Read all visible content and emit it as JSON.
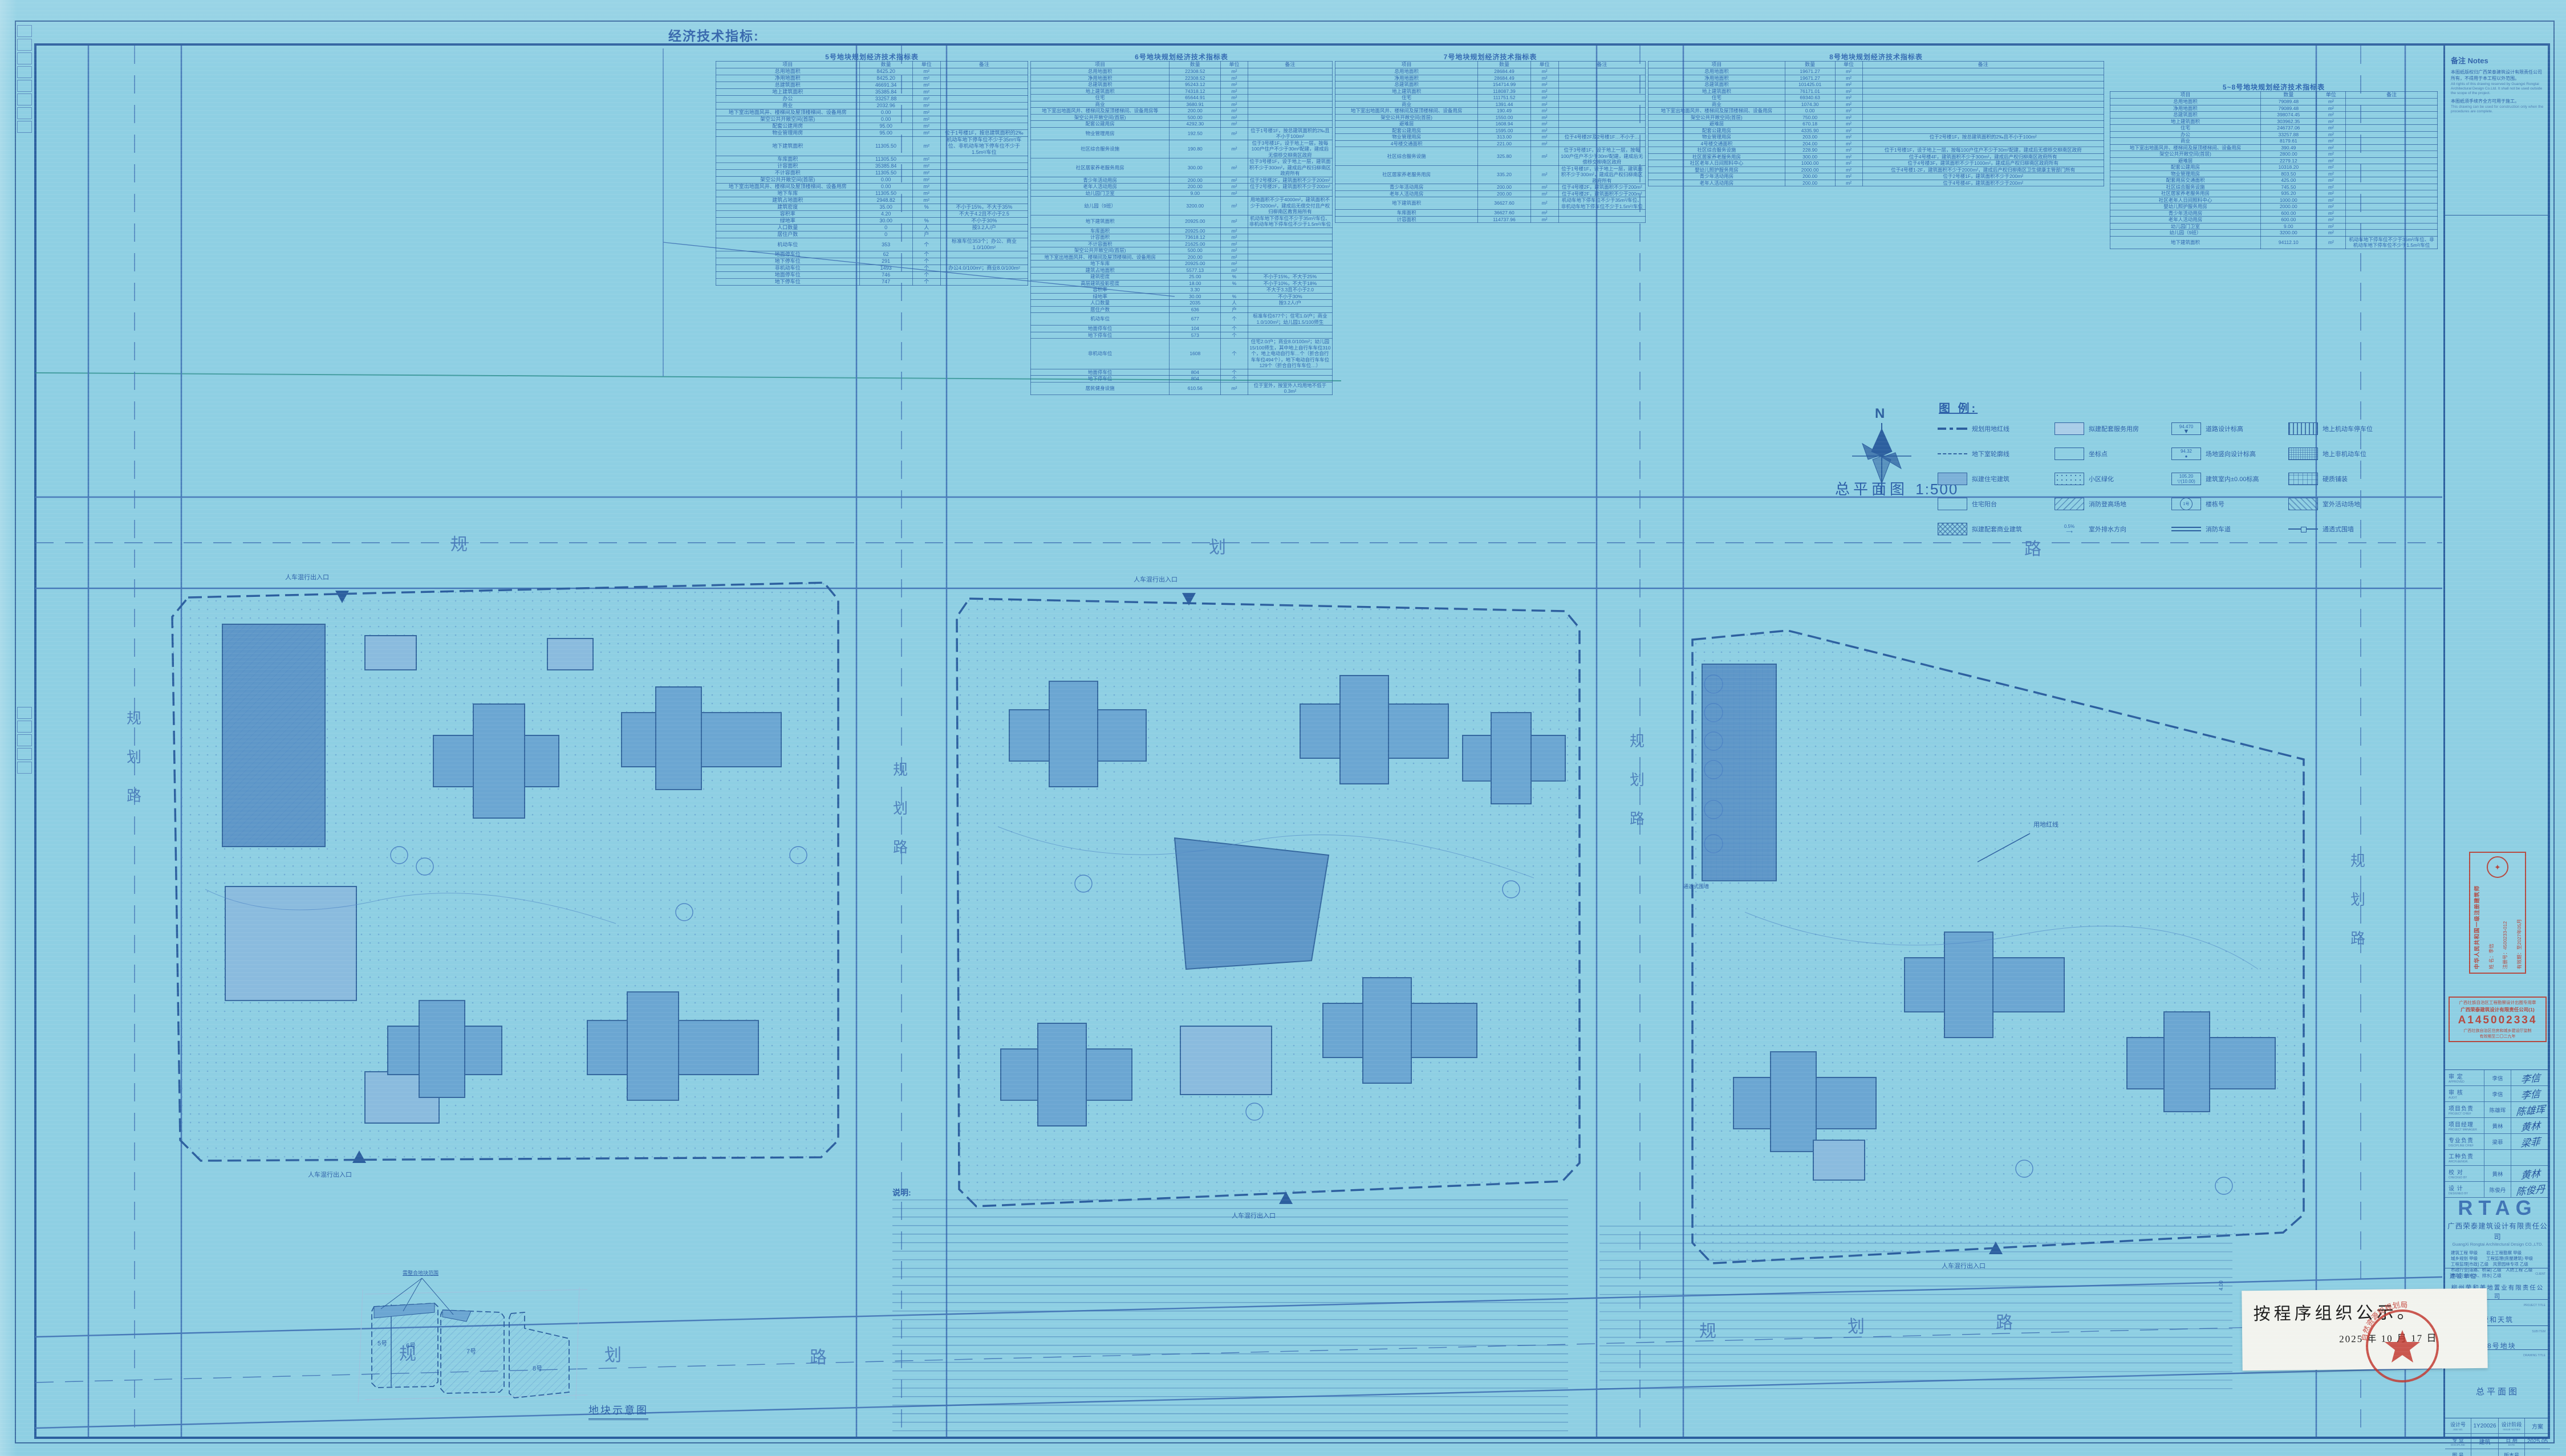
{
  "sheet": {
    "econ_label": "经济技术指标:",
    "plan_title": "总平面图",
    "plan_scale": "1:500",
    "north_letter": "N",
    "schematic_title": "地块示意图",
    "schematic_callout": "需整合地块范围",
    "schematic_plots": [
      "5号",
      "6号",
      "7号",
      "8号"
    ],
    "notes_heading": "说明:",
    "dim_label": "4.00"
  },
  "map_labels": {
    "road": "规划路",
    "road_chars": [
      "规",
      "划",
      "路"
    ],
    "entrance": "人车混行出入口",
    "redline": "用地红线",
    "fence": "通透式围墙"
  },
  "tables": [
    {
      "title": "5号地块规划经济技术指标表",
      "headers": [
        "项目",
        "数量",
        "单位",
        "备注"
      ],
      "rows": [
        [
          "总用地面积",
          "8425.20",
          "m²",
          ""
        ],
        [
          "净用地面积",
          "8425.20",
          "m²",
          ""
        ],
        [
          "总建筑面积",
          "46691.34",
          "m²",
          ""
        ],
        [
          "地上建筑面积",
          "35385.84",
          "m²",
          ""
        ],
        [
          "办公",
          "33257.88",
          "m²",
          ""
        ],
        [
          "商业",
          "2032.96",
          "m²",
          ""
        ],
        [
          "地下室出地面风井、楼梯间及屋顶楼梯间、设备用房",
          "0.00",
          "m²",
          ""
        ],
        [
          "架空公共开敞空间(首层)",
          "0.00",
          "m²",
          ""
        ],
        [
          "配套公建用房",
          "95.00",
          "m²",
          ""
        ],
        [
          "物业管理用房",
          "95.00",
          "m²",
          "位于1号楼1F，按总建筑面积的2‰"
        ],
        [
          "地下建筑面积",
          "11305.50",
          "m²",
          "机动车地下停车位不少于35m²/车位、非机动车地下停车位不少于1.5m²/车位"
        ],
        [
          "车库面积",
          "11305.50",
          "m²",
          ""
        ],
        [
          "计容面积",
          "35385.84",
          "m²",
          ""
        ],
        [
          "不计容面积",
          "11305.50",
          "m²",
          ""
        ],
        [
          "架空公共开敞空间(首层)",
          "0.00",
          "m²",
          ""
        ],
        [
          "地下室出地面风井、楼梯间及屋顶楼梯间、设备用房",
          "0.00",
          "m²",
          ""
        ],
        [
          "地下车库",
          "11305.50",
          "m²",
          ""
        ],
        [
          "建筑占地面积",
          "2948.82",
          "m²",
          ""
        ],
        [
          "建筑密度",
          "35.00",
          "%",
          "不小于15%，不大于35%"
        ],
        [
          "容积率",
          "4.20",
          "",
          "不大于4.2且不小于2.5"
        ],
        [
          "绿地率",
          "30.00",
          "%",
          "不小于30%"
        ],
        [
          "人口数量",
          "0",
          "人",
          "按3.2人/户"
        ],
        [
          "居住户数",
          "0",
          "户",
          ""
        ],
        [
          "机动车位",
          "353",
          "个",
          "标准车位353个；办公、商业1.0/100m²"
        ],
        [
          "地面停车位",
          "62",
          "个",
          ""
        ],
        [
          "地下停车位",
          "291",
          "个",
          ""
        ],
        [
          "非机动车位",
          "1493",
          "个",
          "办公4.0/100m²；商业8.0/100m²"
        ],
        [
          "地面停车位",
          "746",
          "个",
          ""
        ],
        [
          "地下停车位",
          "747",
          "个",
          ""
        ]
      ]
    },
    {
      "title": "6号地块规划经济技术指标表",
      "headers": [
        "项目",
        "数量",
        "单位",
        "备注"
      ],
      "rows": [
        [
          "总用地面积",
          "22308.52",
          "m²",
          ""
        ],
        [
          "净用地面积",
          "22308.52",
          "m²",
          ""
        ],
        [
          "总建筑面积",
          "95243.12",
          "m²",
          ""
        ],
        [
          "地上建筑面积",
          "74318.12",
          "m²",
          ""
        ],
        [
          "住宅",
          "65644.91",
          "m²",
          ""
        ],
        [
          "商业",
          "3680.91",
          "m²",
          ""
        ],
        [
          "地下室出地面风井、楼梯间及屋顶楼梯间、设备用房等",
          "200.00",
          "m²",
          ""
        ],
        [
          "架空公共开敞空间(首层)",
          "500.00",
          "m²",
          ""
        ],
        [
          "配套公建用房",
          "4292.30",
          "m²",
          ""
        ],
        [
          "物业管理用房",
          "192.50",
          "m²",
          "位于1号楼1F，按总建筑面积的2‰且不小于100m²"
        ],
        [
          "社区综合服务设施",
          "190.80",
          "m²",
          "位于3号楼1F，设于地上一层，按每100户住户不少于30m²配建，建成后无偿移交柳南区政府"
        ],
        [
          "社区居家养老服务用房",
          "300.00",
          "m²",
          "位于3号楼1F，设于地上一层，建筑面积不少于300m²，建成后产权归柳南区政府所有"
        ],
        [
          "青少年活动用房",
          "200.00",
          "m²",
          "位于2号楼2F，建筑面积不少于200m²"
        ],
        [
          "老年人活动用房",
          "200.00",
          "m²",
          "位于2号楼2F，建筑面积不少于200m²"
        ],
        [
          "幼儿园门卫室",
          "9.00",
          "m²",
          ""
        ],
        [
          "幼儿园（9班）",
          "3200.00",
          "m²",
          "用地面积不少于4000m²，建筑面积不少于3200m²，建成后无偿交付且产权归柳南区教育局所有"
        ],
        [
          "地下建筑面积",
          "20925.00",
          "m²",
          "机动车地下停车位不少于35m²/车位、非机动车地下停车位不少于1.5m²/车位"
        ],
        [
          "车库面积",
          "20925.00",
          "m²",
          ""
        ],
        [
          "计容面积",
          "73618.12",
          "m²",
          ""
        ],
        [
          "不计容面积",
          "21625.00",
          "m²",
          ""
        ],
        [
          "架空公共开敞空间(首层)",
          "500.00",
          "m²",
          ""
        ],
        [
          "地下室出地面风井、楼梯间及屋顶楼梯间、设备用房",
          "200.00",
          "m²",
          ""
        ],
        [
          "地下车库",
          "20925.00",
          "m²",
          ""
        ],
        [
          "建筑占地面积",
          "5577.13",
          "m²",
          ""
        ],
        [
          "建筑密度",
          "25.00",
          "%",
          "不小于15%，不大于25%"
        ],
        [
          "高层建筑投影密度",
          "18.00",
          "%",
          "不小于10%，不大于18%"
        ],
        [
          "容积率",
          "3.30",
          "",
          "不大于3.3且不小于2.0"
        ],
        [
          "绿地率",
          "30.00",
          "%",
          "不小于30%"
        ],
        [
          "人口数量",
          "2035",
          "人",
          "按3.2人/户"
        ],
        [
          "居住户数",
          "636",
          "户",
          ""
        ],
        [
          "机动车位",
          "677",
          "个",
          "标准车位677个；住宅1.0/户；商业1.0/100m²；幼儿园1.5/100师生"
        ],
        [
          "地面停车位",
          "104",
          "个",
          ""
        ],
        [
          "地下停车位",
          "573",
          "个",
          ""
        ],
        [
          "非机动车位",
          "1608",
          "个",
          "住宅2.0/户；商业8.0/100m²；幼儿园15/100师生，其中地上自行车车位310个，地上电动自行车…个（折合自行车车位494个），地下电动自行车车位129个（折合自行车车位…）"
        ],
        [
          "地面停车位",
          "804",
          "个",
          ""
        ],
        [
          "地下停车位",
          "804",
          "个",
          ""
        ],
        [
          "居民健身设施",
          "610.56",
          "m²",
          "位于室外，按室外人均用地不低于0.3m²"
        ]
      ]
    },
    {
      "title": "7号地块规划经济技术指标表",
      "headers": [
        "项目",
        "数量",
        "单位",
        "备注"
      ],
      "rows": [
        [
          "总用地面积",
          "28684.49",
          "m²",
          ""
        ],
        [
          "净用地面积",
          "28684.49",
          "m²",
          ""
        ],
        [
          "总建筑面积",
          "154714.99",
          "m²",
          ""
        ],
        [
          "地上建筑面积",
          "118087.39",
          "m²",
          ""
        ],
        [
          "住宅",
          "111751.52",
          "m²",
          ""
        ],
        [
          "商业",
          "1391.44",
          "m²",
          ""
        ],
        [
          "地下室出地面风井、楼梯间及屋顶楼梯间、设备用房",
          "190.49",
          "m²",
          ""
        ],
        [
          "架空公共开敞空间(首层)",
          "1550.00",
          "m²",
          ""
        ],
        [
          "避难层",
          "1608.94",
          "m²",
          ""
        ],
        [
          "配套公建用房",
          "1595.00",
          "m²",
          ""
        ],
        [
          "物业管理用房",
          "313.00",
          "m²",
          "位于4号楼2F及2号楼1F…不小于…"
        ],
        [
          "4号楼交通面积",
          "221.00",
          "m²",
          ""
        ],
        [
          "社区综合服务设施",
          "325.80",
          "m²",
          "位于3号楼1F，设于地上一层，按每100户住户不少于30m²配建，建成后无偿移交柳南区政府"
        ],
        [
          "社区居家养老服务用房",
          "335.20",
          "m²",
          "位于1号楼1F，设于地上一层，建筑面积不少于300m²，建成后产权归柳南区政府所有"
        ],
        [
          "青少年活动用房",
          "200.00",
          "m²",
          "位于4号楼2F，建筑面积不少于200m²"
        ],
        [
          "老年人活动用房",
          "200.00",
          "m²",
          "位于4号楼2F，建筑面积不少于200m²"
        ],
        [
          "地下建筑面积",
          "36627.60",
          "m²",
          "机动车地下停车位不少于35m²/车位、非机动车地下停车位不少于1.5m²/车位"
        ],
        [
          "车库面积",
          "36627.60",
          "m²",
          ""
        ],
        [
          "计容面积",
          "114737.96",
          "m²",
          ""
        ]
      ]
    },
    {
      "title": "8号地块规划经济技术指标表",
      "headers": [
        "项目",
        "数量",
        "单位",
        "备注"
      ],
      "rows": [
        [
          "总用地面积",
          "19671.27",
          "m²",
          ""
        ],
        [
          "净用地面积",
          "19671.27",
          "m²",
          ""
        ],
        [
          "总建筑面积",
          "101425.01",
          "m²",
          ""
        ],
        [
          "地上建筑面积",
          "76171.01",
          "m²",
          ""
        ],
        [
          "住宅",
          "69340.63",
          "m²",
          ""
        ],
        [
          "商业",
          "1074.30",
          "m²",
          ""
        ],
        [
          "地下室出地面风井、楼梯间及屋顶楼梯间、设备用房",
          "0.00",
          "m²",
          ""
        ],
        [
          "架空公共开敞空间(首层)",
          "750.00",
          "m²",
          ""
        ],
        [
          "避难层",
          "670.18",
          "m²",
          ""
        ],
        [
          "配套公建用房",
          "4335.90",
          "m²",
          ""
        ],
        [
          "物业管理用房",
          "203.00",
          "m²",
          "位于2号楼1F，按总建筑面积的2‰且不小于100m²"
        ],
        [
          "4号楼交通面积",
          "204.00",
          "m²",
          ""
        ],
        [
          "社区综合服务设施",
          "228.90",
          "m²",
          "位于1号楼1F，设于地上一层，按每100户住户不少于30m²配建，建成后无偿移交柳南区政府"
        ],
        [
          "社区居家养老服务用房",
          "300.00",
          "m²",
          "位于4号楼4F，建筑面积不少于300m²，建成后产权归柳南区政府所有"
        ],
        [
          "社区老年人日间照料中心",
          "1000.00",
          "m²",
          "位于4号楼3F，建筑面积不少于1000m²，建成后产权归柳南区政府所有"
        ],
        [
          "婴幼儿照护服务用房",
          "2000.00",
          "m²",
          "位于4号楼1-2F，建筑面积不少于2000m²，建成后产权归柳南区卫生健康主管部门所有"
        ],
        [
          "青少年活动用房",
          "200.00",
          "m²",
          "位于2号楼1F，建筑面积不少于200m²"
        ],
        [
          "老年人活动用房",
          "200.00",
          "m²",
          "位于4号楼4F，建筑面积不少于200m²"
        ]
      ]
    },
    {
      "title": "5~8号地块规划经济技术指标表",
      "headers": [
        "项目",
        "数量",
        "单位",
        "备注"
      ],
      "rows": [
        [
          "总用地面积",
          "79089.48",
          "m²",
          ""
        ],
        [
          "净用地面积",
          "79089.48",
          "m²",
          ""
        ],
        [
          "总建筑面积",
          "398074.45",
          "m²",
          ""
        ],
        [
          "地上建筑面积",
          "303962.35",
          "m²",
          ""
        ],
        [
          "住宅",
          "246737.06",
          "m²",
          ""
        ],
        [
          "办公",
          "33257.88",
          "m²",
          ""
        ],
        [
          "商业",
          "8179.61",
          "m²",
          ""
        ],
        [
          "地下室出地面风井、楼梯间及屋顶楼梯间、设备用房",
          "390.49",
          "m²",
          ""
        ],
        [
          "架空公共开敞空间(首层)",
          "2800.00",
          "m²",
          ""
        ],
        [
          "避难层",
          "2279.12",
          "m²",
          ""
        ],
        [
          "配套公建用房",
          "10318.20",
          "m²",
          ""
        ],
        [
          "物业管理用房",
          "803.50",
          "m²",
          ""
        ],
        [
          "配套用房交通面积",
          "425.00",
          "m²",
          ""
        ],
        [
          "社区综合服务设施",
          "745.50",
          "m²",
          ""
        ],
        [
          "社区居家养老服务用房",
          "935.20",
          "m²",
          ""
        ],
        [
          "社区老年人日间照料中心",
          "1000.00",
          "m²",
          ""
        ],
        [
          "婴幼儿照护服务用房",
          "2000.00",
          "m²",
          ""
        ],
        [
          "青少年活动用房",
          "600.00",
          "m²",
          ""
        ],
        [
          "老年人活动用房",
          "600.00",
          "m²",
          ""
        ],
        [
          "幼儿园门卫室",
          "9.00",
          "m²",
          ""
        ],
        [
          "幼儿园（9班）",
          "3200.00",
          "m²",
          ""
        ],
        [
          "地下建筑面积",
          "94112.10",
          "m²",
          "机动车地下停车位不少于35m²/车位、非机动车地下停车位不少于1.5m²/车位"
        ]
      ]
    }
  ],
  "legend": {
    "title": "图 例:",
    "items": [
      {
        "symbol": "redline",
        "label": "规划用地红线"
      },
      {
        "symbol": "basement",
        "label": "地下室轮廓线"
      },
      {
        "symbol": "resid",
        "label": "拟建住宅建筑"
      },
      {
        "symbol": "balcony",
        "label": "住宅阳台"
      },
      {
        "symbol": "commercial",
        "label": "拟建配套商业建筑"
      },
      {
        "symbol": "service",
        "label": "拟建配套服务用房"
      },
      {
        "symbol": "coord",
        "label": "坐标点"
      },
      {
        "symbol": "green",
        "label": "小区绿化"
      },
      {
        "symbol": "fire",
        "label": "消防登高场地"
      },
      {
        "symbol": "drain",
        "label": "室外排水方向",
        "value": "0.5%"
      },
      {
        "symbol": "roadelev",
        "label": "道路设计标高",
        "value": "94.470"
      },
      {
        "symbol": "siteelev",
        "label": "场地竖向设计标高",
        "value": "94.32"
      },
      {
        "symbol": "bldgelev",
        "label": "建筑室内±0.00标高",
        "value": "105.20",
        "value2": "(10.00)"
      },
      {
        "symbol": "bldgno",
        "label": "楼栋号",
        "value": "1号"
      },
      {
        "symbol": "firelane",
        "label": "消防车道"
      },
      {
        "symbol": "parking",
        "label": "地上机动车停车位"
      },
      {
        "symbol": "bike",
        "label": "地上非机动车位"
      },
      {
        "symbol": "paving",
        "label": "硬质铺装"
      },
      {
        "symbol": "activity",
        "label": "室外活动场地"
      },
      {
        "symbol": "fence",
        "label": "通透式围墙"
      }
    ]
  },
  "titleblock": {
    "notes": {
      "title": "备注  Notes",
      "items": [
        {
          "cn": "本图纸版权归广西荣泰建筑设计有限责任公司所有，不得用于本工程以外范围。",
          "en": "All rights of this drawing reserved by Guangxi Rongtai Architectural Design Co.Ltd. It shall not be used outside the scope of the project."
        },
        {
          "cn": "本图纸须手续齐全方可用于施工。",
          "en": "This drawing can be used for construction only when the procedures are complete."
        }
      ]
    },
    "arch_stamp": {
      "title": "中华人民共和国一级注册建筑师",
      "name_label": "姓 名：",
      "name": "李信",
      "reg_label": "注册号：",
      "reg": "4500233-012",
      "valid_label": "有效期：",
      "valid": "至2027年05月"
    },
    "seal_box": {
      "line1": "广西壮族自治区工程勘察设计出图专用章",
      "line2": "广西荣泰建筑设计有限责任公司(1)",
      "number": "A145002334",
      "line4": "广西壮族自治区住房和城乡建设厅监制",
      "line5": "有效期至二〇二九年"
    },
    "signatures": [
      {
        "label": "审 定",
        "en": "APPROVED",
        "name": "李信"
      },
      {
        "label": "审 核",
        "en": "AUDIT",
        "name": "李信"
      },
      {
        "label": "项目负责",
        "en": "PROJECT CHIEF",
        "name": "陈雄珲"
      },
      {
        "label": "项目经理",
        "en": "PROJECT MANAGER",
        "name": "黄林"
      },
      {
        "label": "专业负责",
        "en": "DISCIPLINE CHIEF",
        "name": "梁菲"
      },
      {
        "label": "工种负责",
        "en": "ARCH.&ENGR.",
        "name": ""
      },
      {
        "label": "校 对",
        "en": "CHECKED BY",
        "name": "黄林"
      },
      {
        "label": "设 计",
        "en": "DESIGNED BY",
        "name": "陈俊丹"
      }
    ],
    "logo": "RTAG",
    "company_cn": "广西荣泰建筑设计有限责任公司",
    "company_en": "GuangXi Rongtai Architectural Design CO.,LTD.",
    "qualifications": [
      "建筑工程 甲级　　岩土工程勘察 甲级",
      "城乡规划 甲级　　工程监理(房屋建筑) 甲级",
      "工程监理[市政] 乙级　风景园林专项 乙级",
      "市政行业[道路、桥梁] 乙级　人防工程 乙级",
      "市政行业[给水、排水] 乙级"
    ],
    "client_label": "建设单位",
    "client_en": "CLIENT",
    "client": "柳州荣和美地置业有限责任公司",
    "project_label": "项目名称",
    "project_en": "PROJECT TITLE",
    "project": "荣和天筑",
    "subitem_label": "子项名称",
    "subitem_en": "SUB ITEM",
    "subitem": "5-8号地块",
    "dwgname_label": "图　名",
    "dwgname_en": "DRAWING TITLE",
    "dwgname": "总平面图",
    "job_label": "设计号",
    "job_en": "JOB NO.",
    "job": "1Y20026",
    "stage_label": "设计阶段",
    "stage_en": "ISSUE NOTES",
    "stage": "方案",
    "discipline_label": "专 业",
    "discipline_en": "DISCIPLINE",
    "discipline": "建筑",
    "date_label": "日 期",
    "date_en": "DATE",
    "date": "2025.05",
    "dwgno_label": "图 号",
    "dwgno_en": "DWG. NO.",
    "dwgno": "",
    "ver_label": "版本号",
    "ver_en": "VER. NO.",
    "ver": "",
    "barcode_digits": "7 88728 318276"
  },
  "notice": {
    "text": "按程序组织公示。",
    "date": "2025 年 10 月 17 日",
    "seal_text": "自然资源和规划局"
  }
}
